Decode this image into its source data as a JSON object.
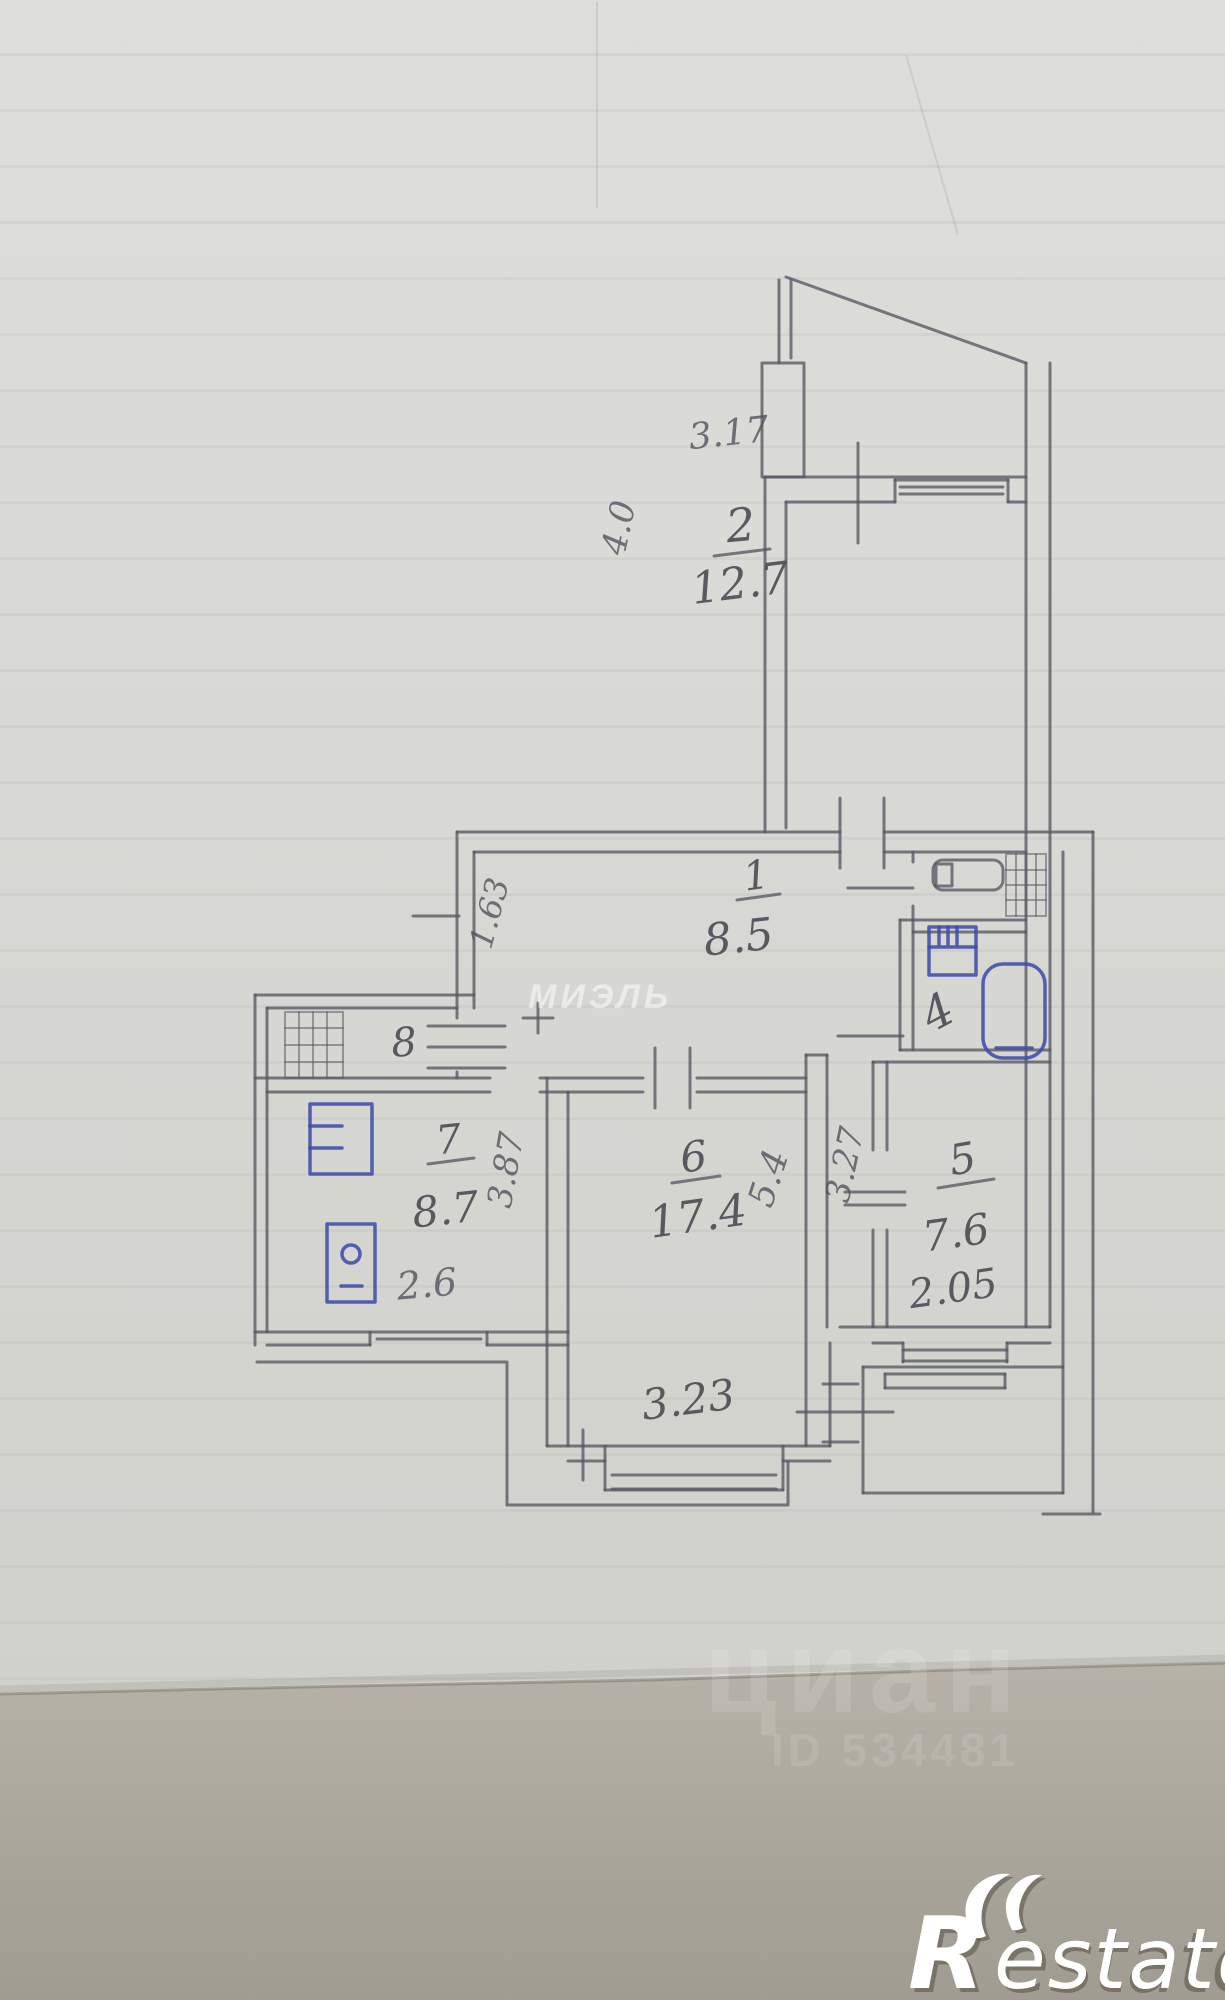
{
  "document": {
    "kind": "scanned hand-drawn apartment floor plan (BTI sketch), pencil on lined paper with blue-ink fixtures"
  },
  "plan": {
    "rooms": {
      "hall": {
        "number": "1",
        "area": "8.5"
      },
      "room2": {
        "number": "2",
        "area": "12.7"
      },
      "bathroom": {
        "number": "4"
      },
      "room5": {
        "number": "5",
        "area": "7.6",
        "width": "2.05"
      },
      "room6": {
        "number": "6",
        "area": "17.4"
      },
      "kitchen": {
        "number": "7",
        "area": "8.7",
        "width": "2.6"
      },
      "room8": {
        "number": "8"
      }
    },
    "dimensions": {
      "room2_width": "3.17",
      "room2_depth": "4.0",
      "hall_niche": "1.63",
      "kitchen_depth": "3.87",
      "room6_depth": "5.4",
      "corridor_depth": "3.27",
      "room6_width": "3.23"
    },
    "colors": {
      "pencil": "#565861",
      "ink": "#3f4da8",
      "paper": "#d8d8d4",
      "paper_bottom": "#afaa9f"
    }
  },
  "watermarks": {
    "agency": "МИЭЛЬ",
    "portal": "циан",
    "portal_id": "ID 534481",
    "logo": {
      "r": "R",
      "rest": "estate"
    }
  }
}
